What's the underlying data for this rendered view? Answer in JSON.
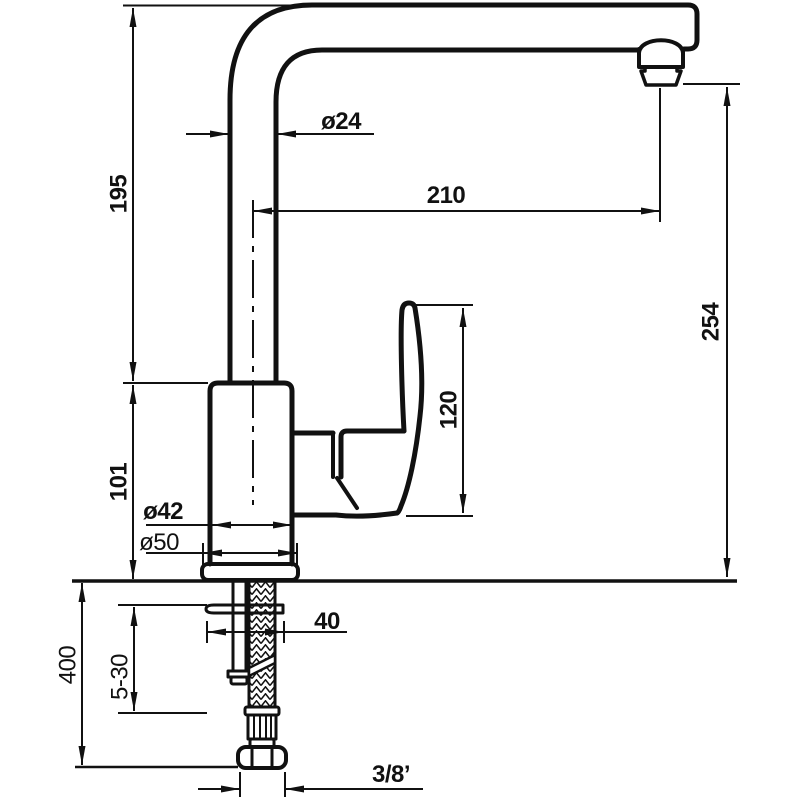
{
  "colors": {
    "line": "#111111",
    "background": "#ffffff"
  },
  "dimensions": {
    "pipe_height": "195",
    "pipe_diameter": "ø24",
    "spout_reach": "210",
    "overall_height": "254",
    "handle_height": "120",
    "body_height": "101",
    "body_diameter": "ø42",
    "base_diameter": "ø50",
    "mount_width": "40",
    "deck_thickness": "5-30",
    "hose_length": "400",
    "thread_size": "3/8’"
  }
}
